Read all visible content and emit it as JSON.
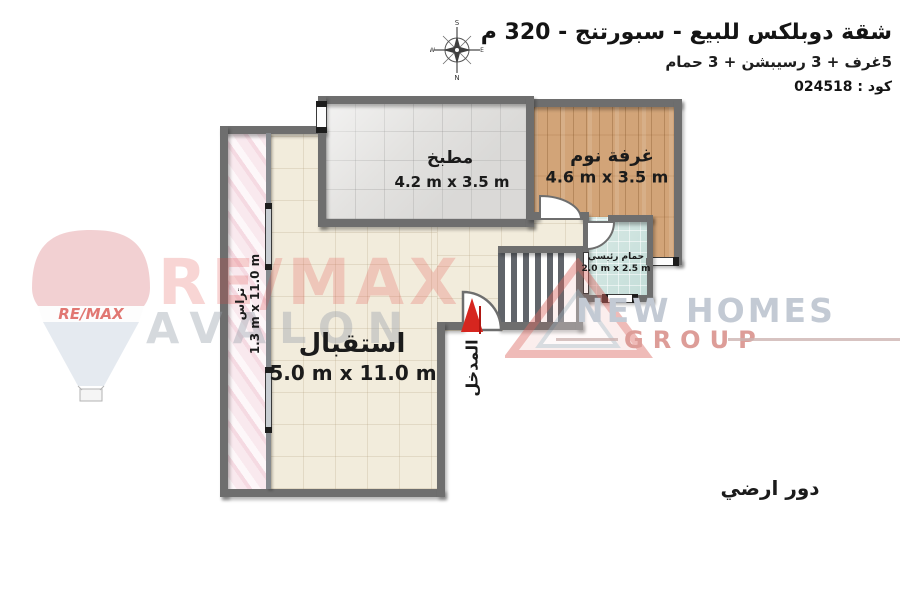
{
  "header": {
    "title": "شقة دوبلكس للبيع - سبورتنج - 320 م",
    "subtitle": "5غرف + 3 رسيبشن + 3 حمام",
    "code": "كود : 024518"
  },
  "compass": {
    "top": "S",
    "bottom": "N",
    "left": "W",
    "right": "E"
  },
  "plan": {
    "rooms": {
      "kitchen": {
        "name": "مطبخ",
        "dims": "4.2 m x 3.5 m"
      },
      "bedroom": {
        "name": "غرفة نوم",
        "dims": "4.6 m x 3.5 m"
      },
      "bathroom": {
        "name": "حمام رئيسي",
        "dims": "2.0 m x 2.5 m"
      },
      "reception": {
        "name": "استقبال",
        "dims": "5.0 m x 11.0 m"
      },
      "terrace": {
        "name": "تراس",
        "dims": "1.3 m x 11.0 m"
      }
    },
    "entrance_label": "المدخل",
    "floor_label": "دور ارضي"
  },
  "watermarks": {
    "remax": "RE/MAX",
    "avalon": "AVALON",
    "balloon_text": "RE/MAX",
    "newhomes": "NEW HOMES",
    "group": "GROUP"
  },
  "colors": {
    "wall": "#6e6e6e",
    "entrance_arrow": "#d6261f",
    "remax_red": "#e2453f",
    "watermark_gray": "#c3cad4",
    "kitchen_floor": "#e3e2e0",
    "bedroom_floor": "#d2a478",
    "bathroom_floor": "#cde3de",
    "reception_floor": "#f2ecdc",
    "terrace_floor": "#f9e9ee"
  }
}
